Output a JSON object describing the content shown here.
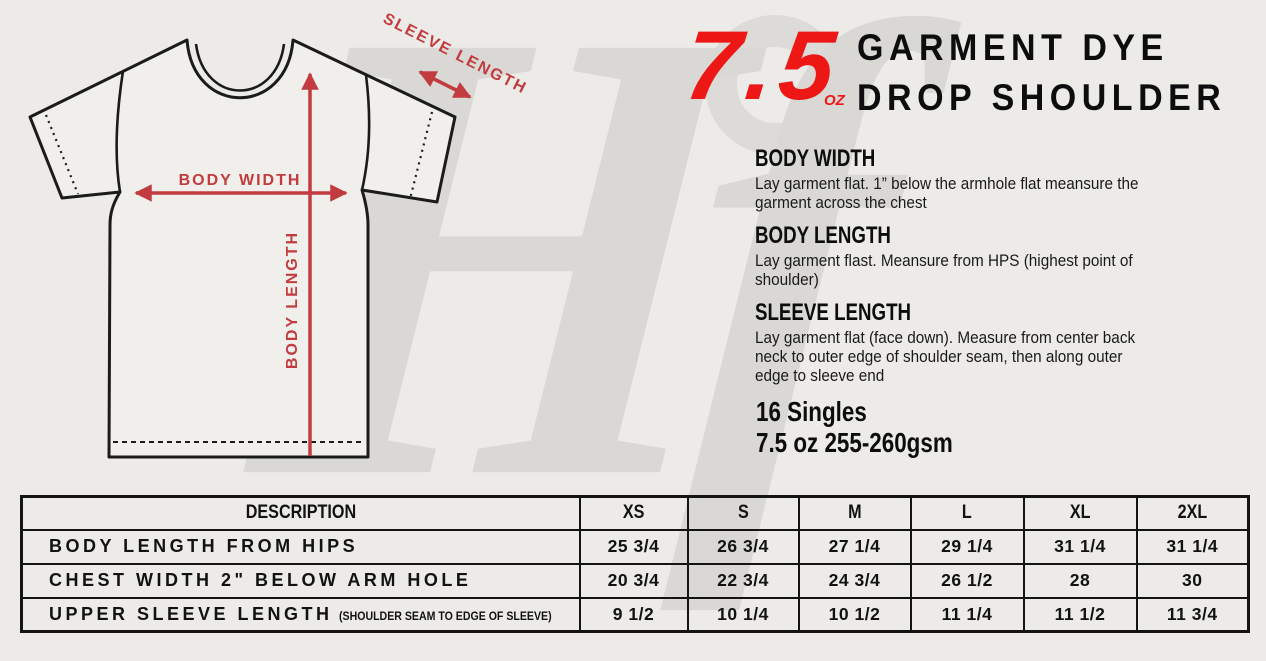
{
  "branding": {
    "watermark_letters": "Hf"
  },
  "colors": {
    "accent_red": "#ed1715",
    "measure_red": "#c23b3f",
    "background": "#ecebe7",
    "watermark_gray": "#d9d8d4"
  },
  "header": {
    "weight_value": "7.5",
    "weight_unit": "OZ",
    "title_line1": "GARMENT DYE",
    "title_line2": "DROP SHOULDER"
  },
  "diagram": {
    "body_width_label": "BODY WIDTH",
    "body_length_label": "BODY LENGTH",
    "sleeve_length_label": "SLEEVE LENGTH"
  },
  "sections": [
    {
      "heading": "BODY WIDTH",
      "lines": [
        "Lay garment flat. 1” below the armhole flat meansure the",
        "garment across the chest"
      ]
    },
    {
      "heading": "BODY LENGTH",
      "lines": [
        "Lay garment flast. Meansure from HPS (highest point of",
        "shoulder)"
      ]
    },
    {
      "heading": "SLEEVE LENGTH",
      "lines": [
        "Lay garment flat (face down). Measure from center back",
        "neck to outer edge of shoulder seam, then along outer",
        "edge to sleeve end"
      ]
    }
  ],
  "fabric": {
    "line1": "16 Singles",
    "line2": "7.5 oz 255-260gsm"
  },
  "table": {
    "headers": [
      "DESCRIPTION",
      "XS",
      "S",
      "M",
      "L",
      "XL",
      "2XL"
    ],
    "rows": [
      {
        "label": "BODY LENGTH FROM HIPS",
        "note": "",
        "values": [
          "25 3/4",
          "26 3/4",
          "27 1/4",
          "29 1/4",
          "31 1/4",
          "31 1/4"
        ]
      },
      {
        "label": "CHEST WIDTH 2\" BELOW ARM HOLE",
        "note": "",
        "values": [
          "20 3/4",
          "22 3/4",
          "24 3/4",
          "26 1/2",
          "28",
          "30"
        ]
      },
      {
        "label": "UPPER SLEEVE LENGTH",
        "note": "(SHOULDER SEAM TO EDGE OF SLEEVE)",
        "values": [
          "9 1/2",
          "10 1/4",
          "10 1/2",
          "11 1/4",
          "11 1/2",
          "11 3/4"
        ]
      }
    ]
  }
}
